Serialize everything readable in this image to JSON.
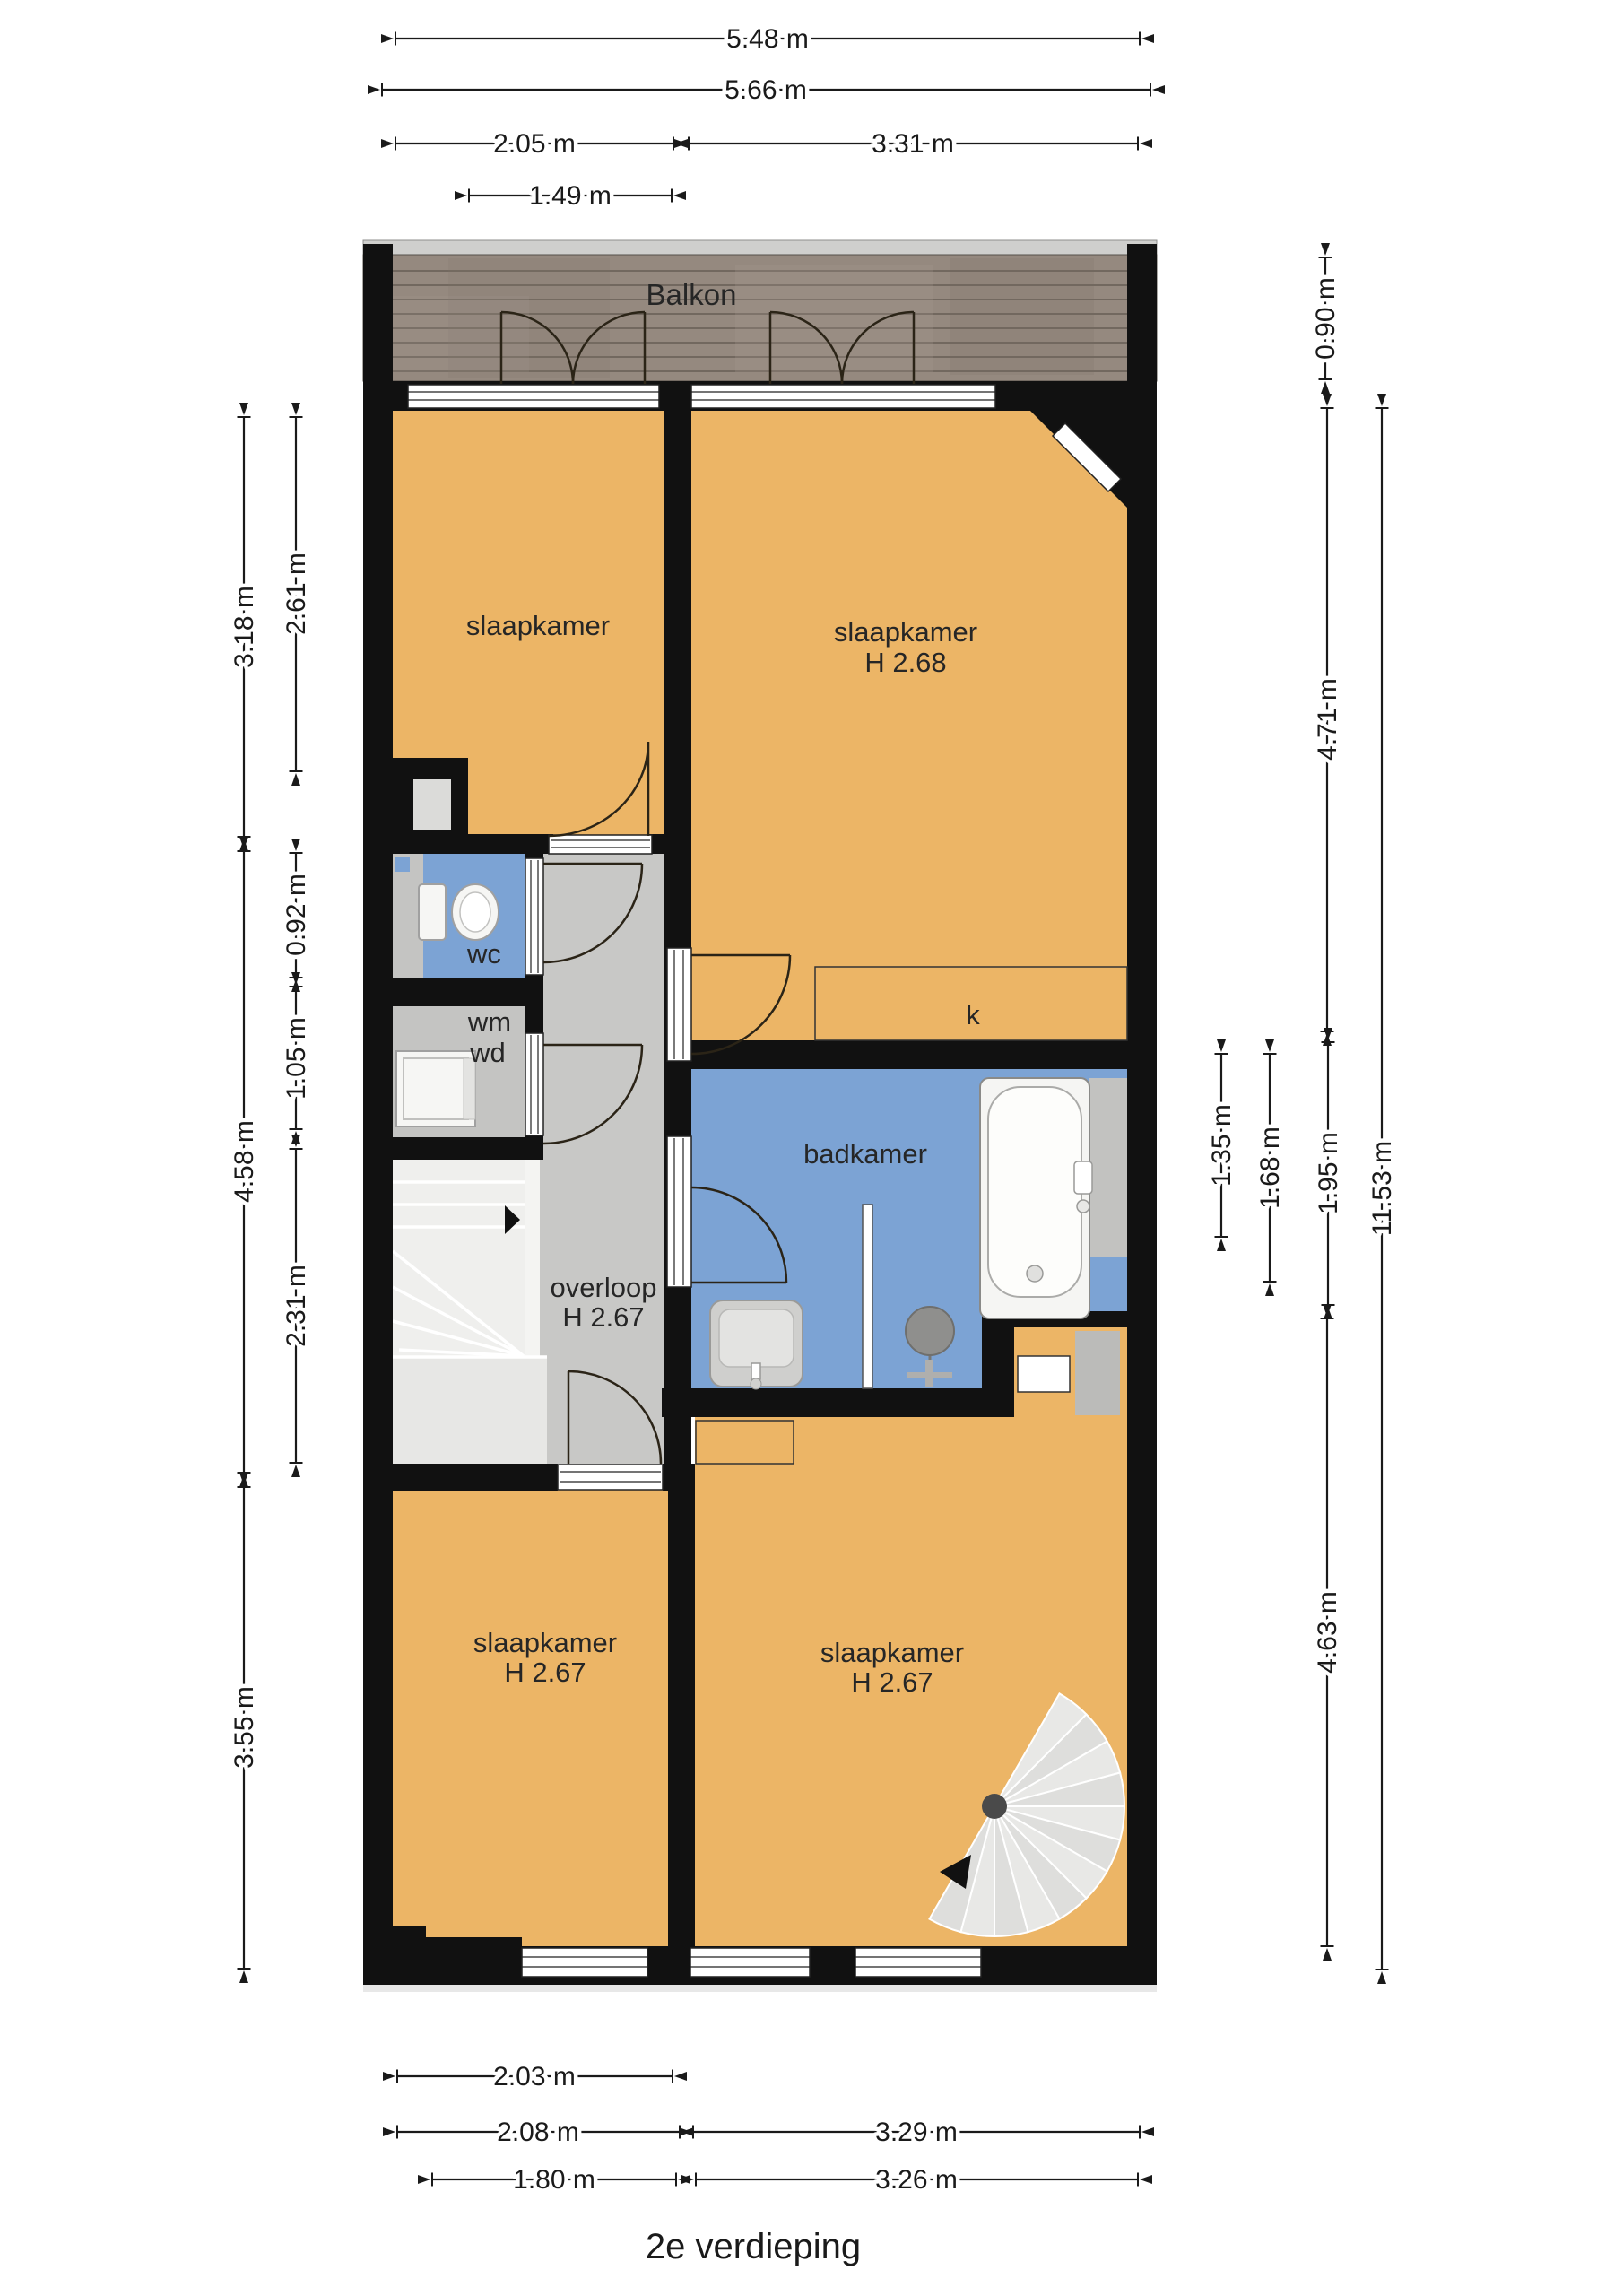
{
  "title": "2e verdieping",
  "balcony": {
    "label": "Balkon"
  },
  "rooms": {
    "bedroom_top_left": {
      "name": "slaapkamer"
    },
    "bedroom_top_right": {
      "name": "slaapkamer",
      "height": "H 2.68"
    },
    "wc": {
      "label": "wc"
    },
    "laundry": {
      "wm": "wm",
      "wd": "wd"
    },
    "closet": {
      "label": "k"
    },
    "bathroom": {
      "label": "badkamer"
    },
    "landing": {
      "name": "overloop",
      "height": "H 2.67"
    },
    "bedroom_bottom_left": {
      "name": "slaapkamer",
      "height": "H 2.67"
    },
    "bedroom_bottom_right": {
      "name": "slaapkamer",
      "height": "H 2.67"
    }
  },
  "dimensions": {
    "top": [
      {
        "label": "5.48 m"
      },
      {
        "label": "5.66 m"
      },
      {
        "label": "2.05 m"
      },
      {
        "label": "3.31 m"
      },
      {
        "label": "1.49 m"
      }
    ],
    "left": [
      {
        "label": "3.18 m"
      },
      {
        "label": "2.61 m"
      },
      {
        "label": "0.92 m"
      },
      {
        "label": "1.05 m"
      },
      {
        "label": "4.58 m"
      },
      {
        "label": "2.31 m"
      },
      {
        "label": "3.55 m"
      }
    ],
    "right": [
      {
        "label": "0.90 m"
      },
      {
        "label": "4.71 m"
      },
      {
        "label": "1.35 m"
      },
      {
        "label": "1.68 m"
      },
      {
        "label": "1.95 m"
      },
      {
        "label": "4.63 m"
      },
      {
        "label": "11.53 m"
      }
    ],
    "bottom": [
      {
        "label": "2.03 m"
      },
      {
        "label": "2.08 m"
      },
      {
        "label": "3.29 m"
      },
      {
        "label": "1.80 m"
      },
      {
        "label": "3.26 m"
      }
    ]
  },
  "colors": {
    "wall": "#111111",
    "room": "#ECB566",
    "wet_room": "#7CA3D4",
    "hallway": "#C8C8C6",
    "stairs": "#EFEFED",
    "balcony_wood": "#95897F",
    "dimension_text": "#1A1A1A"
  }
}
